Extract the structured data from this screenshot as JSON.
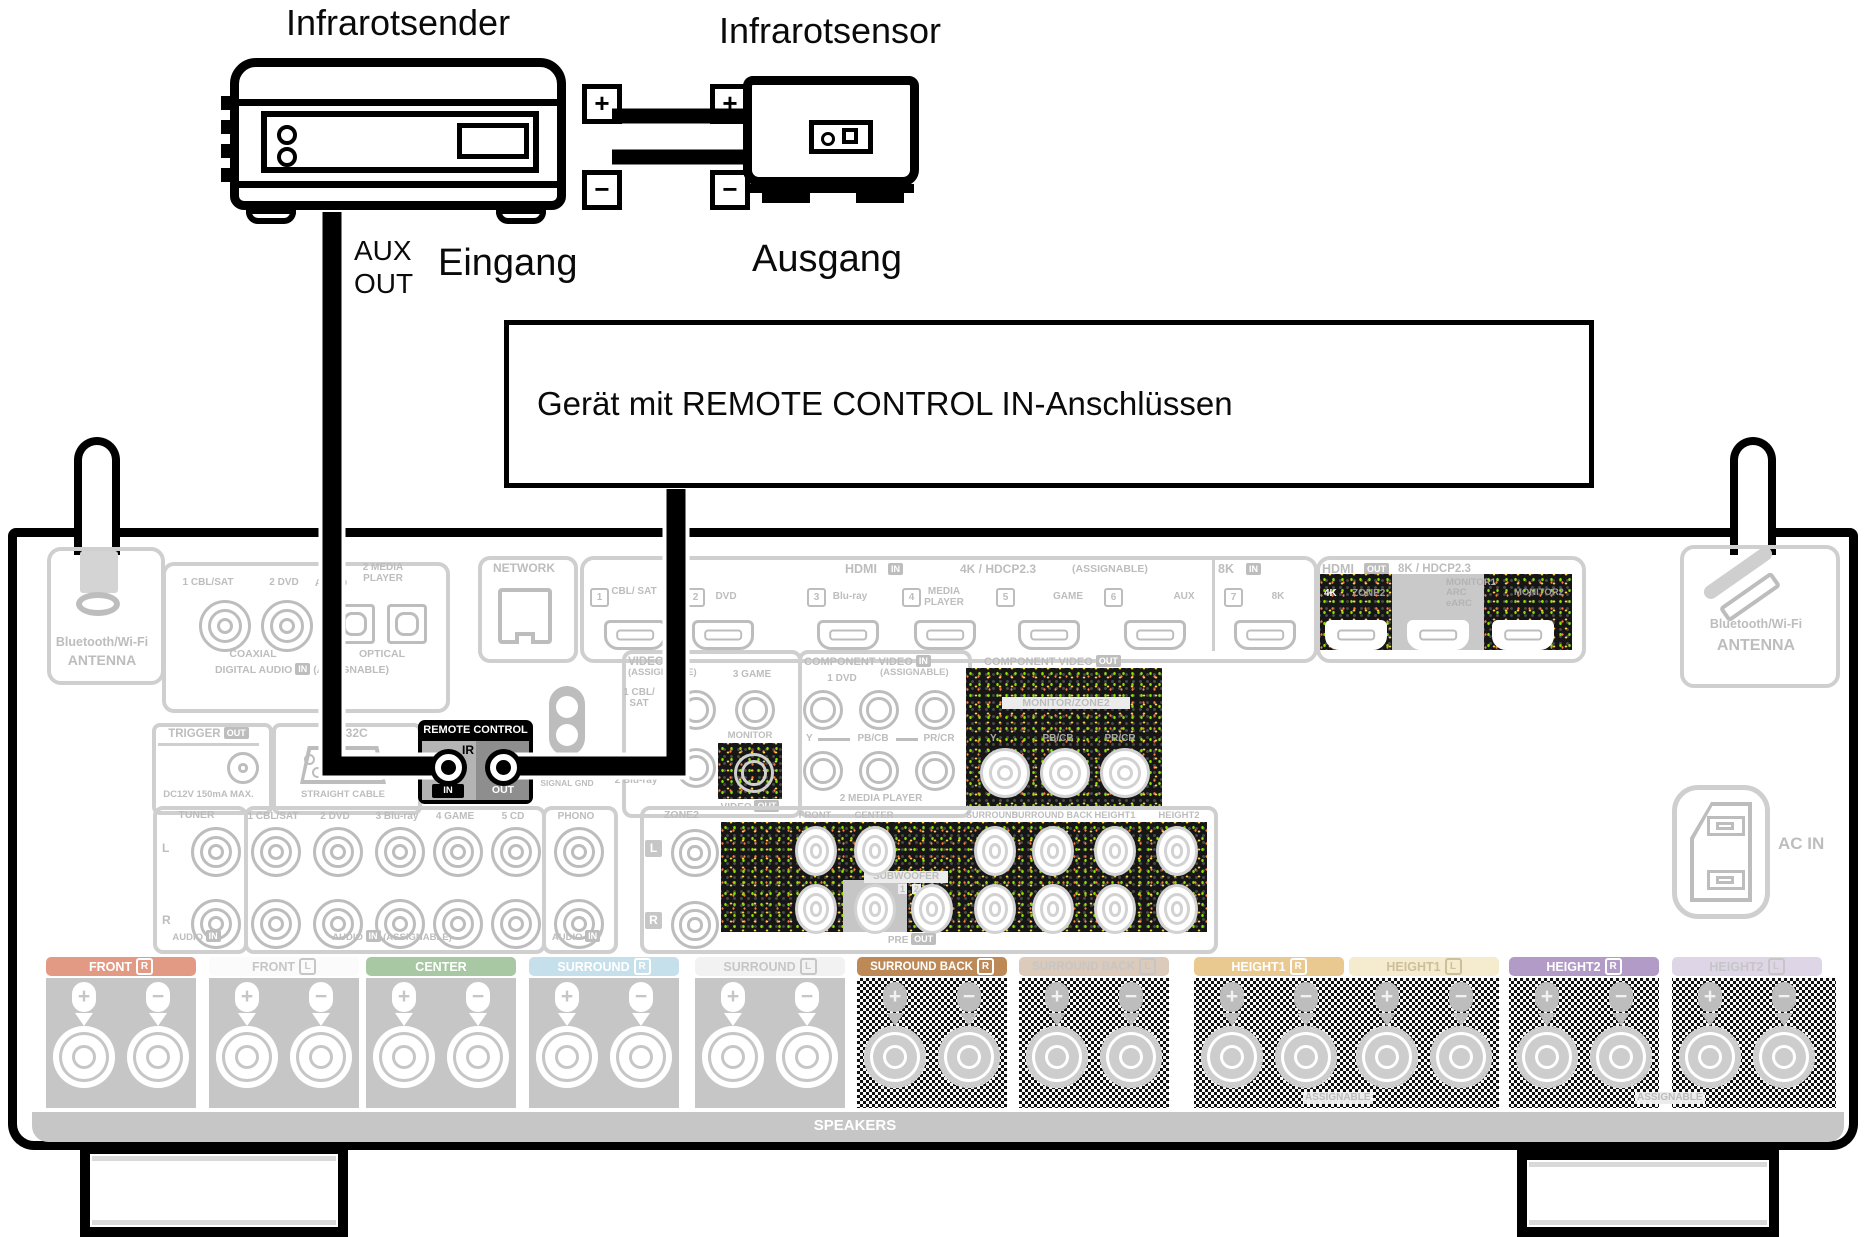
{
  "top": {
    "ir_sender": "Infrarotsender",
    "ir_sensor": "Infrarotsensor",
    "plus": "+",
    "minus": "−",
    "aux_line1": "AUX",
    "aux_line2": "OUT",
    "eingang": "Eingang",
    "ausgang": "Ausgang",
    "device_box": "Gerät mit REMOTE CONTROL IN-Anschlüssen"
  },
  "panel": {
    "plus": "+",
    "minus": "−",
    "bt_left": {
      "l1": "Bluetooth/Wi-Fi",
      "l2": "ANTENNA"
    },
    "bt_right": {
      "l1": "Bluetooth/Wi-Fi",
      "l2": "ANTENNA"
    },
    "network": "NETWORK",
    "digital_audio": {
      "title": "DIGITAL AUDIO",
      "in": "IN",
      "assignable": "(ASSIGNABLE)",
      "coaxial": "COAXIAL",
      "optical": "OPTICAL",
      "j1": "1 CBL/SAT",
      "j2": "2 DVD",
      "j3": "1 TV AUDIO",
      "j4": "2 MEDIA PLAYER"
    },
    "hdmi_in": {
      "title": "HDMI",
      "in": "IN",
      "spec": "4K / HDCP2.3",
      "assignable": "(ASSIGNABLE)",
      "ports": [
        {
          "n": "1",
          "l": "CBL/ SAT"
        },
        {
          "n": "2",
          "l": "DVD"
        },
        {
          "n": "3",
          "l": "Blu-ray"
        },
        {
          "n": "4",
          "l": "MEDIA PLAYER"
        },
        {
          "n": "5",
          "l": "GAME"
        },
        {
          "n": "6",
          "l": "AUX"
        }
      ],
      "t8k": "8K",
      "in8k": "IN",
      "p7n": "7",
      "p7l": "8K"
    },
    "hdmi_out": {
      "title": "HDMI",
      "out": "OUT",
      "spec": "8K / HDCP2.3",
      "k4": "4K",
      "zone2": "ZONE2",
      "mon1": "MONITOR1",
      "arc": "ARC",
      "earc": "eARC",
      "mon2": "MONITOR2"
    },
    "trigger": {
      "title": "TRIGGER",
      "out": "OUT",
      "note": "DC12V 150mA MAX."
    },
    "rs232": {
      "title": "RS-232C",
      "note": "STRAIGHT CABLE"
    },
    "remote": {
      "title": "REMOTE CONTROL",
      "ir": "IR",
      "in": "IN",
      "out": "OUT"
    },
    "gnd": "SIGNAL GND",
    "video_in": {
      "title": "VIDEO",
      "in": "IN",
      "assignable": "(ASSIGNABLE)",
      "j1": "1 CBL/ SAT",
      "j2": "3 GAME",
      "j3": "2 Blu-ray"
    },
    "video_out": {
      "monitor": "MONITOR",
      "title": "VIDEO",
      "out": "OUT"
    },
    "comp_in": {
      "title": "COMPONENT VIDEO",
      "in": "IN",
      "assignable": "(ASSIGNABLE)",
      "dvd": "1 DVD",
      "y": "Y",
      "pb": "PB/CB",
      "pr": "PR/CR",
      "media": "2 MEDIA PLAYER"
    },
    "comp_out": {
      "title": "COMPONENT VIDEO",
      "out": "OUT",
      "zone": "MONITOR/ZONE2",
      "y": "Y",
      "pb": "PB/CB",
      "pr": "PR/CR"
    },
    "tuner": {
      "title": "TUNER",
      "l": "L",
      "r": "R",
      "audio": "AUDIO",
      "in": "IN"
    },
    "audio_in": {
      "j": [
        "1 CBL/SAT",
        "2 DVD",
        "3 Blu-ray",
        "4 GAME",
        "5 CD"
      ],
      "audio": "AUDIO",
      "in": "IN",
      "assignable": "(ASSIGNABLE)"
    },
    "phono": {
      "title": "PHONO",
      "audio": "AUDIO",
      "in": "IN"
    },
    "pre_out": {
      "zone2": "ZONE2",
      "l": "L",
      "r": "R",
      "front": "FRONT",
      "center": "CENTER",
      "sub": "SUBWOOFER",
      "n1": "1",
      "n2": "2",
      "surround": "SURROUND",
      "sback": "SURROUND BACK",
      "h1": "HEIGHT1",
      "h2": "HEIGHT2",
      "pre": "PRE",
      "out": "OUT"
    },
    "ac_in": "AC IN",
    "speakers": "SPEAKERS",
    "assignable": "ASSIGNABLE",
    "tabs": [
      {
        "label": "FRONT",
        "badge": "R",
        "bg": "#e39a84",
        "fg": "#ffffff"
      },
      {
        "label": "FRONT",
        "badge": "L",
        "bg": "#fbfbfb",
        "fg": "#c6c6c6"
      },
      {
        "label": "CENTER",
        "badge": "",
        "bg": "#a7c8a3",
        "fg": "#ffffff"
      },
      {
        "label": "SURROUND",
        "badge": "R",
        "bg": "#c6e0eb",
        "fg": "#ffffff"
      },
      {
        "label": "SURROUND",
        "badge": "L",
        "bg": "#f2f2f2",
        "fg": "#c6c6c6"
      },
      {
        "label": "SURROUND BACK",
        "badge": "R",
        "bg": "#bd8a57",
        "fg": "#ffffff"
      },
      {
        "label": "SURROUND BACK",
        "badge": "L",
        "bg": "#dccaba",
        "fg": "#c6c6c6"
      },
      {
        "label": "HEIGHT1",
        "badge": "R",
        "bg": "#e9c98f",
        "fg": "#ffffff"
      },
      {
        "label": "HEIGHT1",
        "badge": "L",
        "bg": "#f5ebcf",
        "fg": "#ccc09b"
      },
      {
        "label": "HEIGHT2",
        "badge": "R",
        "bg": "#b39bc8",
        "fg": "#ffffff"
      },
      {
        "label": "HEIGHT2",
        "badge": "L",
        "bg": "#ded6e7",
        "fg": "#c6c6c6"
      }
    ],
    "colors": {
      "print_gray": "#bdbdbd",
      "highlight_black": "#000000"
    }
  }
}
